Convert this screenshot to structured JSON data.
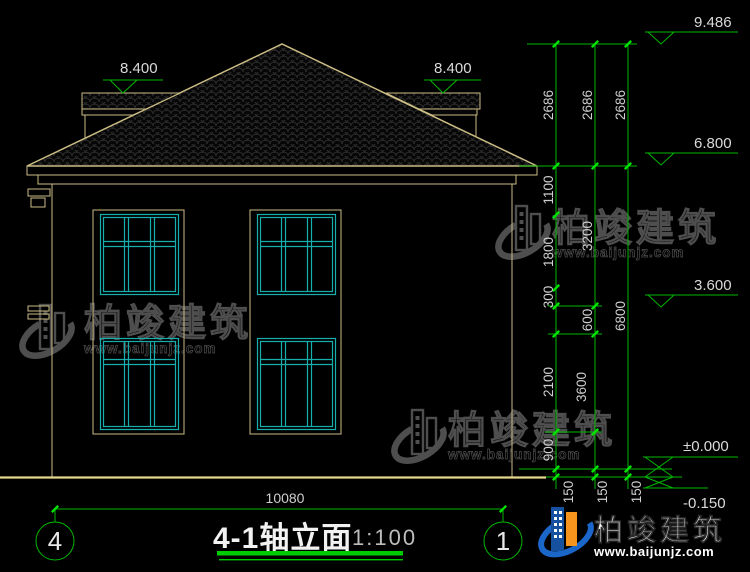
{
  "drawing": {
    "title": "4-1轴立面",
    "scale": "1:100",
    "axis_left": "4",
    "axis_right": "1",
    "total_width": "10080"
  },
  "levels": {
    "ridge": "9.486",
    "eave": "6.800",
    "window_head": "3.600",
    "floor": "±0.000",
    "ground": "-0.150",
    "wing_left": "8.400",
    "wing_right": "8.400"
  },
  "dims": {
    "roof_chain": [
      "2686",
      "2686",
      "2686"
    ],
    "chain_a": [
      "1100",
      "1800",
      "300",
      "2100",
      "900"
    ],
    "chain_b": [
      "3200",
      "600",
      "3600"
    ],
    "chain_c": [
      "6800"
    ],
    "plinth": [
      "150",
      "150",
      "150"
    ]
  },
  "watermark": {
    "brand": "柏竣建筑",
    "site": "www.baijunjz.com"
  },
  "logo": {
    "brand": "柏竣建筑",
    "site": "www.baijunjz.com"
  },
  "colors": {
    "background": "#000000",
    "building_line": "#CBBC84",
    "dimension_line": "#00B800",
    "window_line": "#17AEAE",
    "text": "#D6D6D6",
    "title_underline": "#00CC00",
    "logo_blue": "#1B66C9",
    "logo_orange": "#F7941D"
  }
}
